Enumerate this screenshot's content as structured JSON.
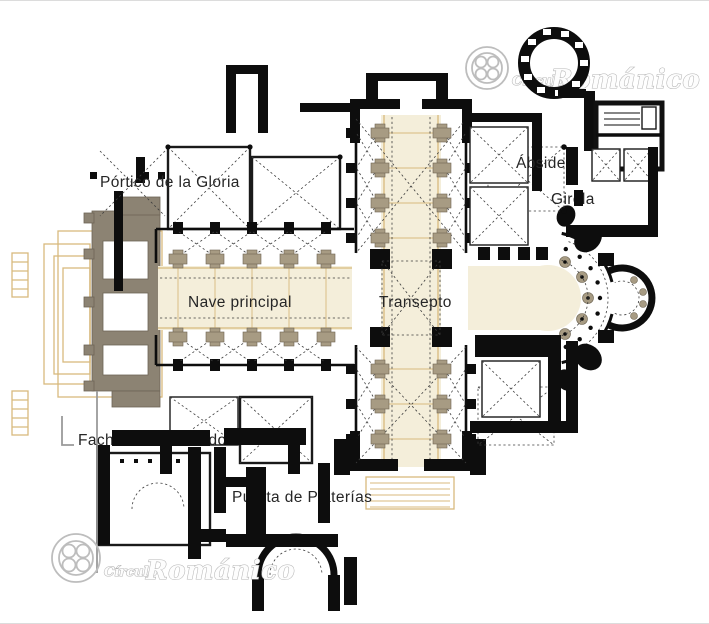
{
  "plan": {
    "labels": {
      "portico": "Pórtico de la Gloria",
      "nave": "Nave principal",
      "transepto": "Transepto",
      "abside": "Ábside",
      "girola": "Girola",
      "fachada": "Fachada del Obradoiro",
      "platerias": "Puerta de Platerías"
    },
    "colors": {
      "romanesque_wall": "#0d0d0d",
      "later_structures": "#8c8373",
      "stair_outline": "#d8ba7e",
      "pier": "#a79b83",
      "vault_fill": "#f4eeda",
      "label_text": "#262626",
      "watermark": "#b5b5b5"
    }
  },
  "watermark": {
    "prefix": "Círculo",
    "name": "Románico"
  }
}
